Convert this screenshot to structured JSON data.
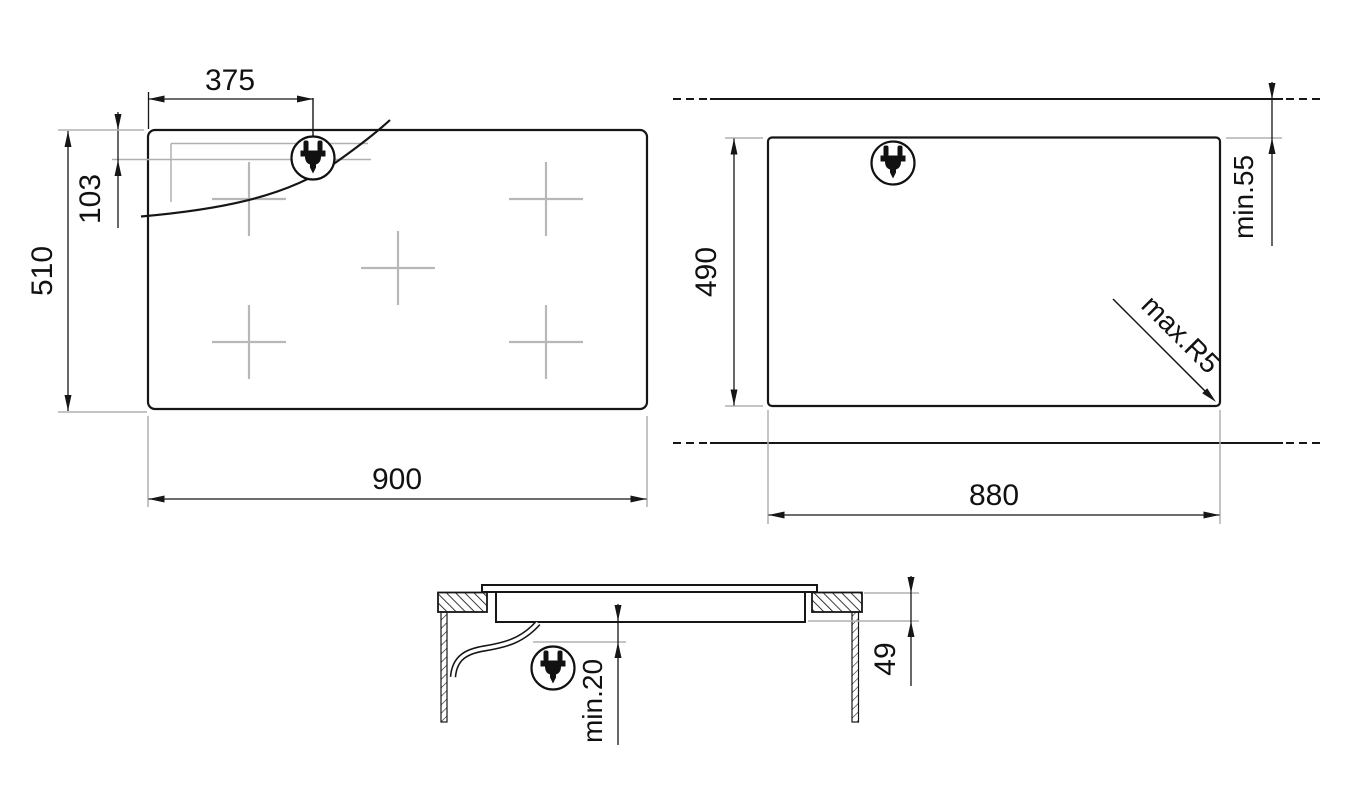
{
  "plan": {
    "dim_width": "900",
    "dim_height": "510",
    "dim_plug_x": "375",
    "dim_plug_y": "103"
  },
  "cutout": {
    "dim_width": "880",
    "dim_height": "490",
    "dim_rear": "min.55",
    "dim_radius": "max.R5"
  },
  "section": {
    "dim_depth": "49",
    "dim_clearance": "min.20"
  },
  "icons": {
    "plug": "power-plug-in-circle"
  },
  "colors": {
    "line": "#161616",
    "gray": "#b0b0b0"
  }
}
